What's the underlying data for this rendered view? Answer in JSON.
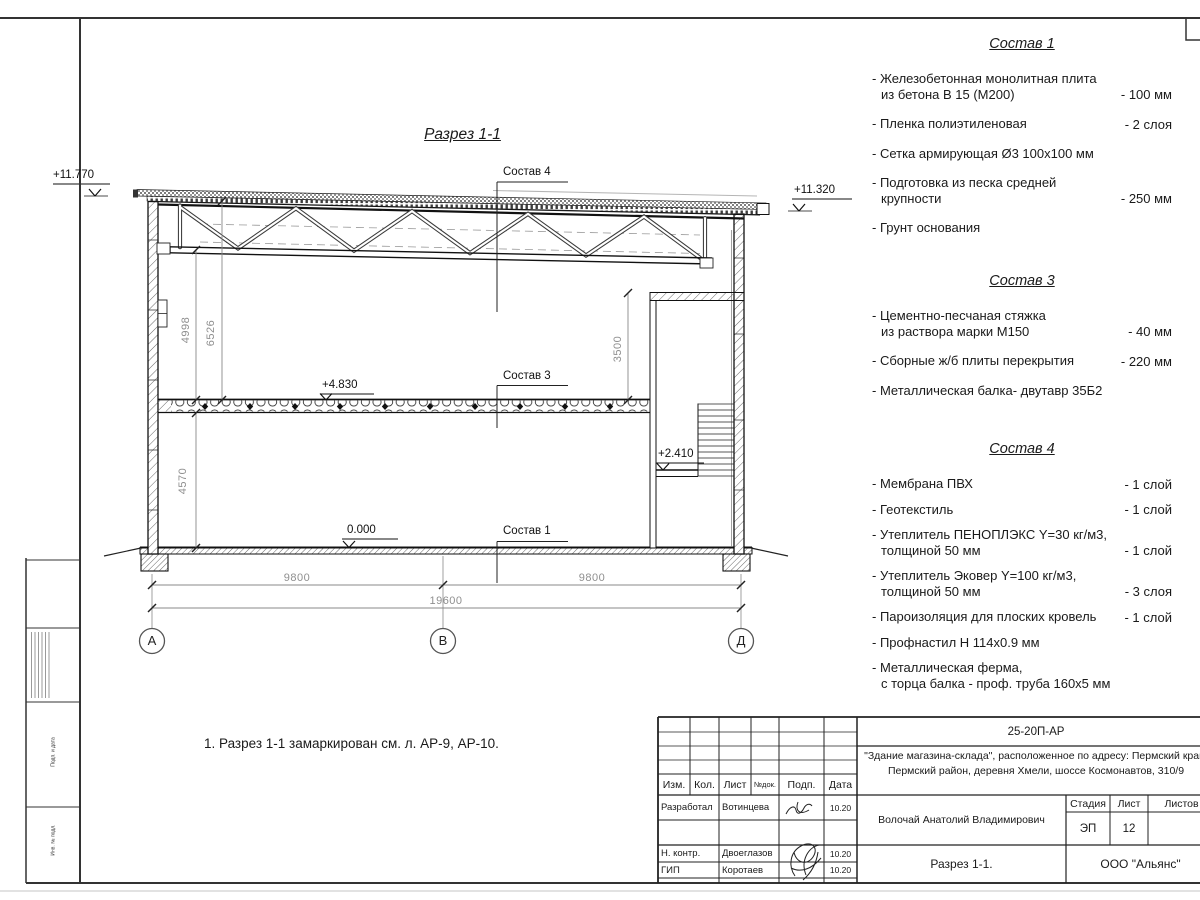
{
  "sheet": {
    "section_title": "Разрез 1-1",
    "note": "1. Разрез 1-1 замаркирован см. л. АР-9, АР-10."
  },
  "elevations": {
    "roof_high": "+11.770",
    "roof_low": "+11.320",
    "slab": "+4.830",
    "landing": "+2.410",
    "zero": "0.000"
  },
  "dims": {
    "left_truss": "4998",
    "left_roof": "6526",
    "room": "3500",
    "left_floor": "4570",
    "span1": "9800",
    "span2": "9800",
    "total": "19600"
  },
  "axes": [
    "А",
    "В",
    "Д"
  ],
  "callouts": {
    "c4": "Состав 4",
    "c3": "Состав 3",
    "c1": "Состав 1"
  },
  "lists": [
    {
      "title": "Состав 1",
      "items": [
        {
          "line1": "- Железобетонная  монолитная плита",
          "line2": "из бетона В 15 (М200)",
          "value": "- 100 мм"
        },
        {
          "line1": "- Пленка полиэтиленовая",
          "value": "-  2 слоя"
        },
        {
          "line1": "- Сетка армирующая Ø3 100х100 мм"
        },
        {
          "line1": "- Подготовка из песка средней",
          "line2": "крупности",
          "value": "- 250 мм"
        },
        {
          "line1": "- Грунт основания"
        }
      ]
    },
    {
      "title": "Состав 3",
      "items": [
        {
          "line1": "- Цементно-песчаная стяжка",
          "line2": "из раствора марки М150",
          "value": "- 40 мм"
        },
        {
          "line1": "- Сборные ж/б плиты перекрытия",
          "value": "- 220 мм"
        },
        {
          "line1": "- Металлическая балка- двутавр 35Б2"
        }
      ]
    },
    {
      "title": "Состав 4",
      "items": [
        {
          "line1": "- Мембрана ПВХ",
          "value": "- 1 слой"
        },
        {
          "line1": "- Геотекстиль",
          "value": "- 1 слой"
        },
        {
          "line1": "- Утеплитель ПЕНОПЛЭКС Y=30 кг/м3,",
          "line2": "толщиной 50 мм",
          "value": "- 1 слой"
        },
        {
          "line1": "- Утеплитель Эковер Y=100 кг/м3,",
          "line2": "толщиной 50 мм",
          "value": "- 3 слоя"
        },
        {
          "line1": "- Пароизоляция для плоских кровель",
          "value": "- 1 слой"
        },
        {
          "line1": "- Профнастил Н 114х0.9 мм"
        },
        {
          "line1": "- Металлическая ферма,",
          "line2": "с торца балка - проф. труба 160х5 мм"
        }
      ]
    }
  ],
  "title_block": {
    "doc_number": "25-20П-АР",
    "project_line1": "\"Здание магазина-склада\", расположенное по адресу: Пермский край,",
    "project_line2": "Пермский район, деревня Хмели, шоссе Космонавтов, 310/9",
    "headers": {
      "izm": "Изм.",
      "kol": "Кол.",
      "list": "Лист",
      "doc": "№док.",
      "podp": "Подп.",
      "data": "Дата"
    },
    "rows": [
      {
        "role": "Разработал",
        "name": "Вотинцева",
        "date": "10.20"
      },
      {
        "role": "Н. контр.",
        "name": "Двоеглазов",
        "date": "10.20"
      },
      {
        "role": "ГИП",
        "name": "Коротаев",
        "date": "10.20"
      }
    ],
    "author": "Волочай Анатолий Владимирович",
    "stage_label": "Стадия",
    "sheet_label": "Лист",
    "sheets_label": "Листов",
    "stage": "ЭП",
    "sheet_no": "12",
    "drawing_name": "Разрез 1-1.",
    "company": "ООО \"Альянс\""
  },
  "side_stamp": {
    "labels": [
      "Подп. и дата",
      "Инв. № подл."
    ]
  }
}
